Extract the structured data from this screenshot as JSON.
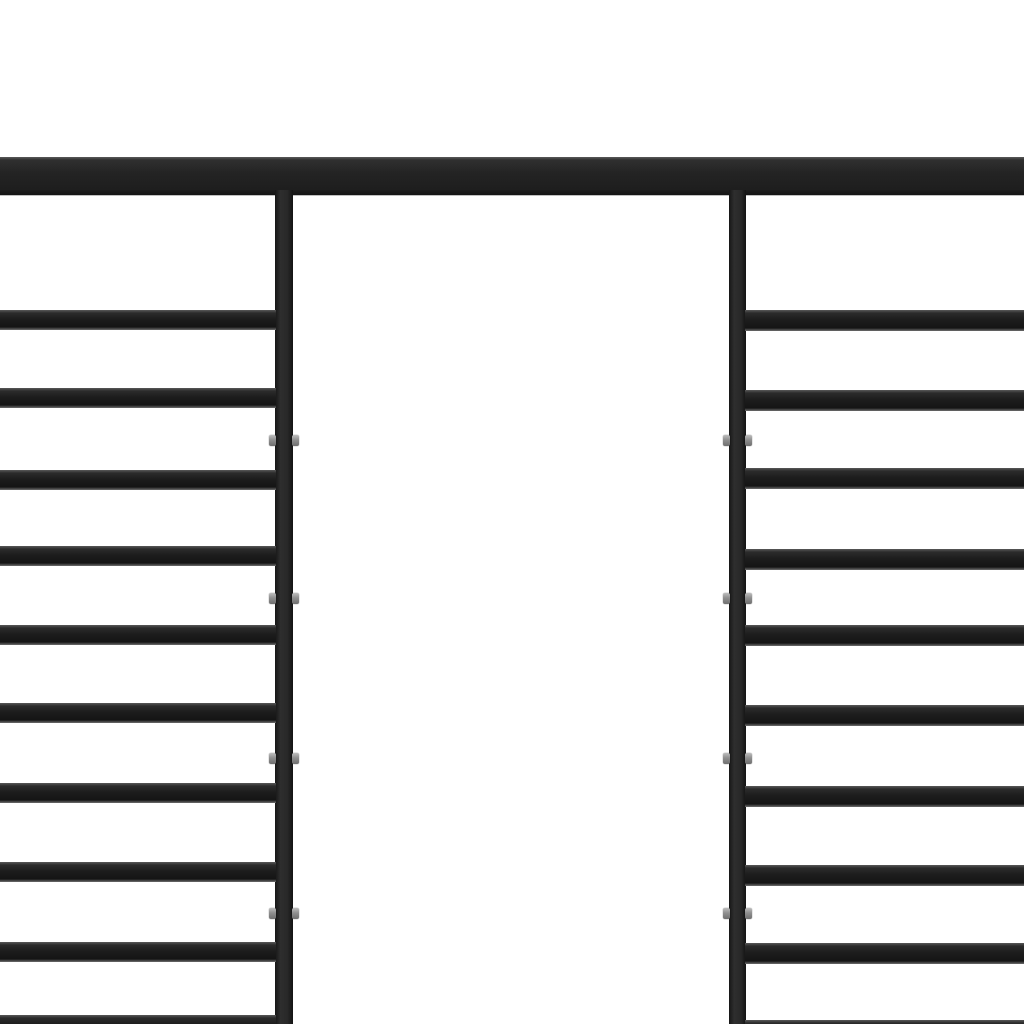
{
  "scene": {
    "description": "Black powder-coated steel pergola frame photographed on a plain white background: one full-width top beam, two vertical posts, ten horizontal slats on the left side and ten on the right side, open doorway gap in the middle",
    "background_color": "#ffffff",
    "frame_color": "#1f1f1f",
    "frame_highlight_color": "#585858",
    "connector_color": "#9a9a9a"
  },
  "structure": {
    "canvas": {
      "width": 1024,
      "height": 1024
    },
    "top_beam": {
      "x": 0,
      "y": 157,
      "width": 1024,
      "height": 38
    },
    "posts": [
      {
        "id": "left-post",
        "x": 275,
        "y": 190,
        "width": 18,
        "height": 834
      },
      {
        "id": "right-post",
        "x": 729,
        "y": 190,
        "width": 17,
        "height": 834
      }
    ],
    "left_slats": {
      "x": 0,
      "width": 276,
      "height": 20,
      "tops": [
        310,
        388,
        470,
        546,
        625,
        703,
        783,
        862,
        942,
        1015
      ]
    },
    "right_slats": {
      "x": 745,
      "width": 279,
      "height": 21,
      "tops": [
        310,
        390,
        468,
        549,
        625,
        705,
        786,
        865,
        943,
        1020
      ]
    },
    "connectors": {
      "centers_y": [
        440,
        598,
        758,
        913
      ],
      "nub_width": 7,
      "nub_height": 11,
      "protrusion": 6
    }
  }
}
